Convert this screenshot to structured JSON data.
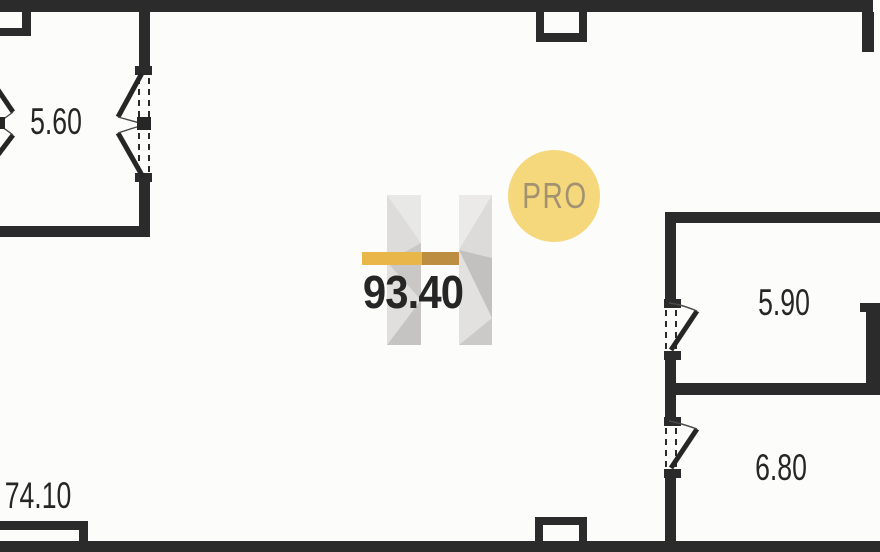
{
  "plan": {
    "rooms": {
      "top_left": {
        "area": "5.60"
      },
      "main": {
        "area": "93.40"
      },
      "right_upper": {
        "area": "5.90"
      },
      "right_lower": {
        "area": "6.80"
      },
      "bottom_left": {
        "area": "74.10"
      }
    }
  },
  "watermark": {
    "badge_text": "PRO"
  },
  "colors": {
    "wall": "#2b2b2b",
    "background": "#fcfcfb",
    "label_text": "#262626",
    "accent_gold": "#e9b64a",
    "accent_gold_dark": "#bd8d42",
    "logo_gray": "#d6d5d3",
    "badge_fill": "#f6d87c",
    "badge_text_color": "#a29272"
  }
}
